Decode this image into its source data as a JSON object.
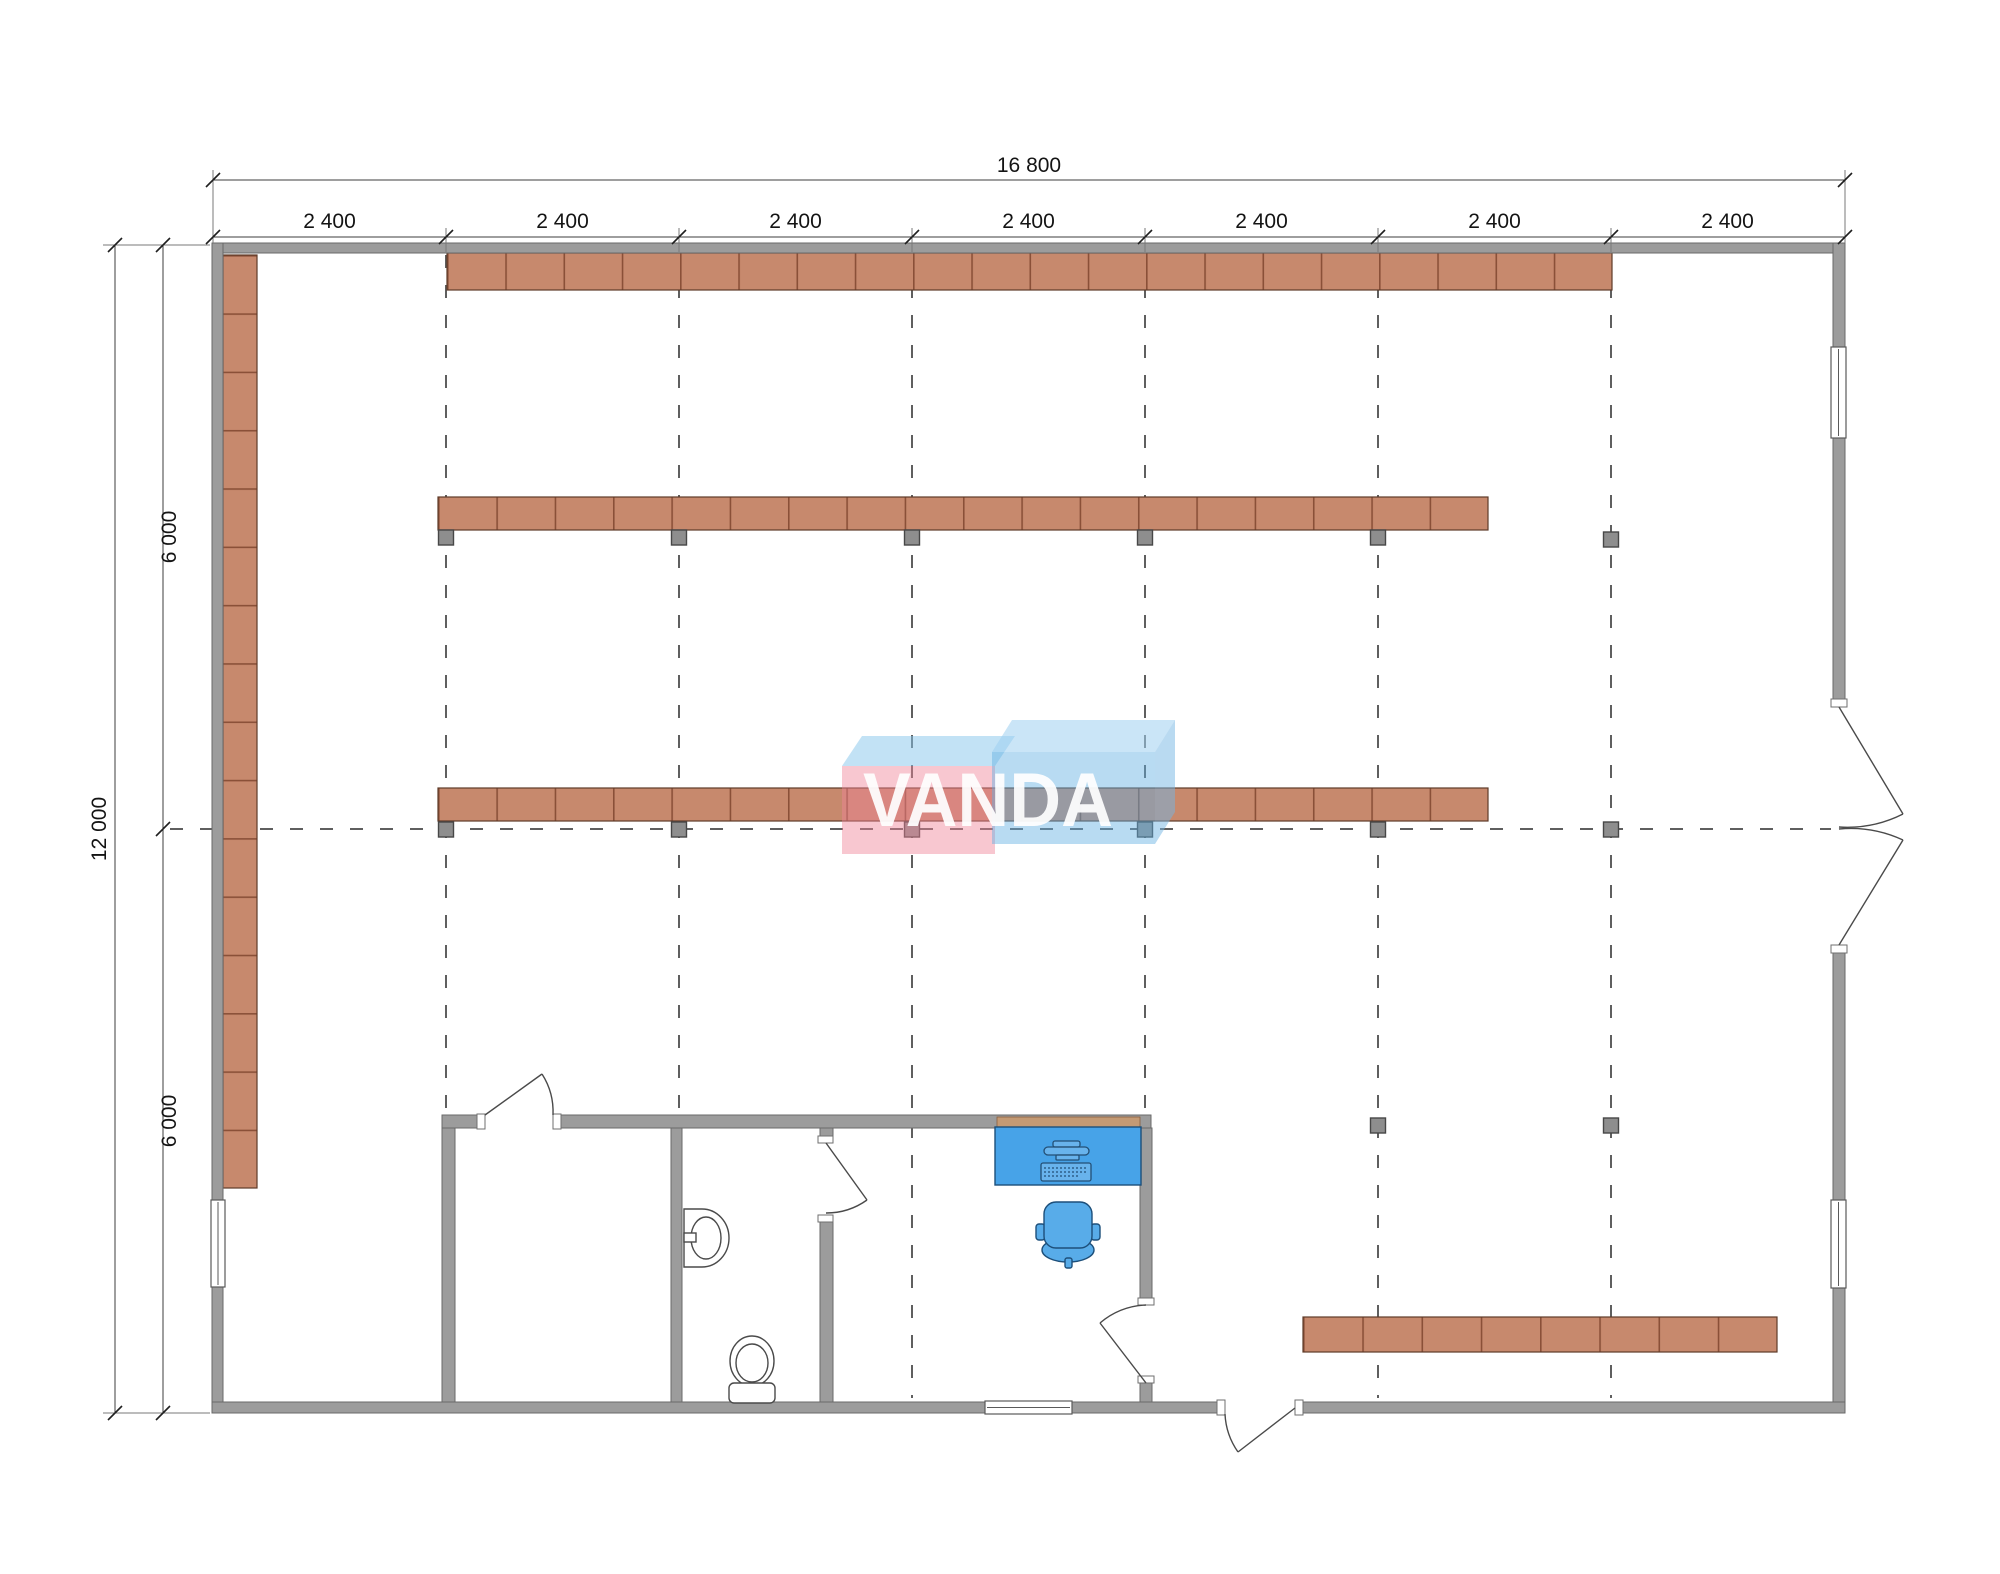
{
  "watermark": {
    "text": "VANDA"
  },
  "dimensions": {
    "overall_width_label": "16 800",
    "bay_labels": [
      "2 400",
      "2 400",
      "2 400",
      "2 400",
      "2 400",
      "2 400",
      "2 400"
    ],
    "overall_height_label": "12 000",
    "height_segment_labels": [
      "6 000",
      "6 000"
    ]
  },
  "colors": {
    "background": "#ffffff",
    "wall": "#9c9c9c",
    "shelf": "#c7896d",
    "shelf_divider": "#8a5038",
    "column": "#8e8e8e",
    "grid_line": "#5f5f5f",
    "desk": "#47a3e8",
    "chair": "#58ace9",
    "watermark_pink": "#f4b9c4",
    "watermark_blue": "#c9e4f6",
    "dimension_text": "#141414"
  },
  "icons": {
    "toilet-icon": "toilet plan symbol (bowl + cistern)",
    "sink-icon": "washbasin plan symbol",
    "desk-icon": "desk with monitor and keyboard",
    "office-chair-icon": "swivel chair plan symbol",
    "door-swing-icon": "door leaf with quarter-circle swing arc",
    "window-icon": "double-line window symbol",
    "shelf-rack-icon": "segmented storage rack",
    "column-icon": "structural column square"
  }
}
